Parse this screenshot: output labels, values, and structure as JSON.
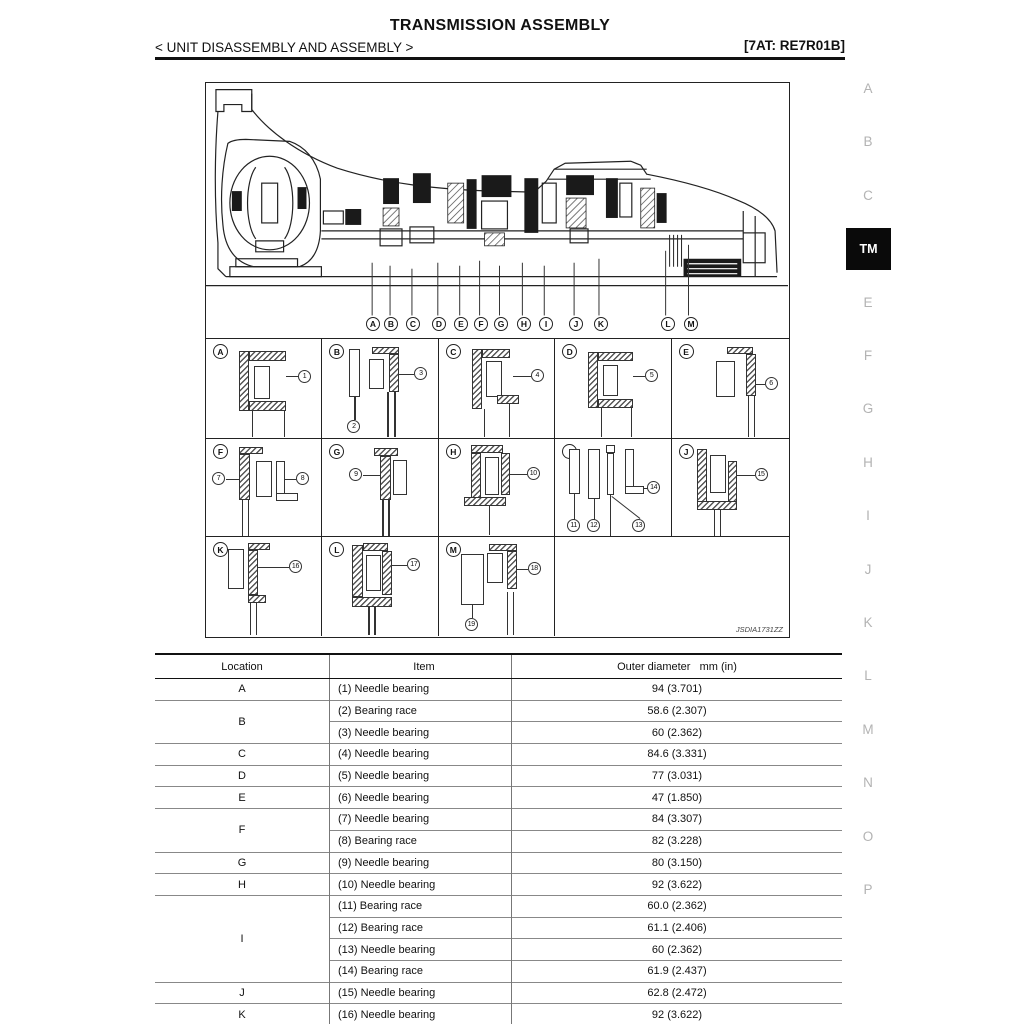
{
  "page": {
    "title": "TRANSMISSION ASSEMBLY",
    "subtitle": "< UNIT DISASSEMBLY AND ASSEMBLY >",
    "model_code": "[7AT: RE7R01B]"
  },
  "figure": {
    "id": "JSDIA1731ZZ",
    "markers": [
      "A",
      "B",
      "C",
      "D",
      "E",
      "F",
      "G",
      "H",
      "I",
      "J",
      "K",
      "L",
      "M"
    ],
    "cells": [
      {
        "letter": "A",
        "callouts": [
          "1"
        ]
      },
      {
        "letter": "B",
        "callouts": [
          "2",
          "3"
        ]
      },
      {
        "letter": "C",
        "callouts": [
          "4"
        ]
      },
      {
        "letter": "D",
        "callouts": [
          "5"
        ]
      },
      {
        "letter": "E",
        "callouts": [
          "6"
        ]
      },
      {
        "letter": "F",
        "callouts": [
          "7",
          "8"
        ]
      },
      {
        "letter": "G",
        "callouts": [
          "9"
        ]
      },
      {
        "letter": "H",
        "callouts": [
          "10"
        ]
      },
      {
        "letter": "I",
        "callouts": [
          "11",
          "12",
          "13",
          "14"
        ]
      },
      {
        "letter": "J",
        "callouts": [
          "15"
        ]
      },
      {
        "letter": "K",
        "callouts": [
          "16"
        ]
      },
      {
        "letter": "L",
        "callouts": [
          "17"
        ]
      },
      {
        "letter": "M",
        "callouts": [
          "18",
          "19"
        ]
      }
    ]
  },
  "sidebar": {
    "items": [
      {
        "label": "A",
        "active": false
      },
      {
        "label": "B",
        "active": false
      },
      {
        "label": "C",
        "active": false
      },
      {
        "label": "TM",
        "active": true
      },
      {
        "label": "E",
        "active": false
      },
      {
        "label": "F",
        "active": false
      },
      {
        "label": "G",
        "active": false
      },
      {
        "label": "H",
        "active": false
      },
      {
        "label": "I",
        "active": false
      },
      {
        "label": "J",
        "active": false
      },
      {
        "label": "K",
        "active": false
      },
      {
        "label": "L",
        "active": false
      },
      {
        "label": "M",
        "active": false
      },
      {
        "label": "N",
        "active": false
      },
      {
        "label": "O",
        "active": false
      },
      {
        "label": "P",
        "active": false
      }
    ]
  },
  "table": {
    "headers": [
      "Location",
      "Item",
      "Outer diameter   mm (in)"
    ],
    "groups": [
      {
        "location": "A",
        "rows": [
          [
            "(1) Needle bearing",
            "94 (3.701)"
          ]
        ]
      },
      {
        "location": "B",
        "rows": [
          [
            "(2) Bearing race",
            "58.6 (2.307)"
          ],
          [
            "(3) Needle bearing",
            "60 (2.362)"
          ]
        ]
      },
      {
        "location": "C",
        "rows": [
          [
            "(4) Needle bearing",
            "84.6 (3.331)"
          ]
        ]
      },
      {
        "location": "D",
        "rows": [
          [
            "(5) Needle bearing",
            "77 (3.031)"
          ]
        ]
      },
      {
        "location": "E",
        "rows": [
          [
            "(6) Needle bearing",
            "47 (1.850)"
          ]
        ]
      },
      {
        "location": "F",
        "rows": [
          [
            "(7) Needle bearing",
            "84 (3.307)"
          ],
          [
            "(8) Bearing race",
            "82 (3.228)"
          ]
        ]
      },
      {
        "location": "G",
        "rows": [
          [
            "(9) Needle bearing",
            "80 (3.150)"
          ]
        ]
      },
      {
        "location": "H",
        "rows": [
          [
            "(10) Needle bearing",
            "92 (3.622)"
          ]
        ]
      },
      {
        "location": "I",
        "rows": [
          [
            "(11) Bearing race",
            "60.0 (2.362)"
          ],
          [
            "(12) Bearing race",
            "61.1 (2.406)"
          ],
          [
            "(13) Needle bearing",
            "60 (2.362)"
          ],
          [
            "(14) Bearing race",
            "61.9 (2.437)"
          ]
        ]
      },
      {
        "location": "J",
        "rows": [
          [
            "(15) Needle bearing",
            "62.8 (2.472)"
          ]
        ]
      },
      {
        "location": "K",
        "rows": [
          [
            "(16) Needle bearing",
            "92 (3.622)"
          ]
        ]
      }
    ]
  },
  "colors": {
    "ink": "#111111",
    "sidebar_letter": "#b3b3b3",
    "tm_tab_bg": "#0a0a0a",
    "tm_tab_text": "#ffffff"
  }
}
